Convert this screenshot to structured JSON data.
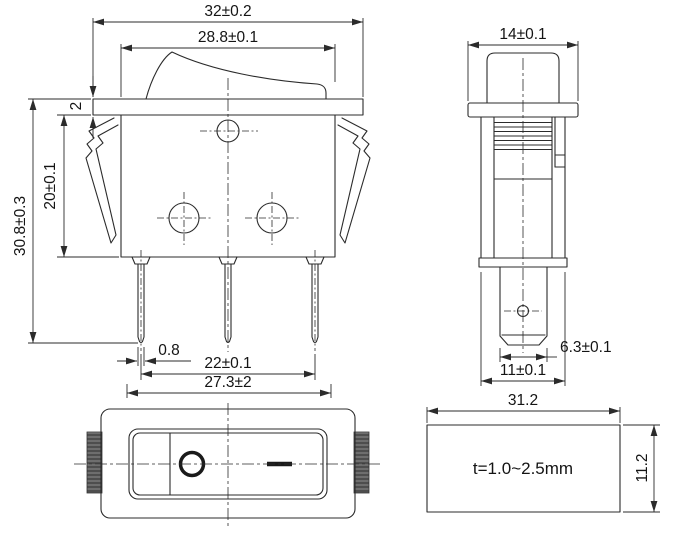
{
  "views": {
    "front": {
      "dims": {
        "overall_width": "32±0.2",
        "bezel_width": "28.8±0.1",
        "flange_thickness": "2",
        "overall_height": "30.8±0.3",
        "body_height": "20±0.1",
        "terminal_thickness": "0.8",
        "terminal_pitch": "22±0.1",
        "clip_span": "27.3±2"
      }
    },
    "side": {
      "dims": {
        "overall_width": "14±0.1",
        "terminal_width": "6.3±0.1",
        "body_width": "11±0.1"
      }
    },
    "cutout": {
      "dims": {
        "width": "31.2",
        "height": "11.2"
      },
      "panel_thickness_note": "t=1.0~2.5mm"
    }
  }
}
